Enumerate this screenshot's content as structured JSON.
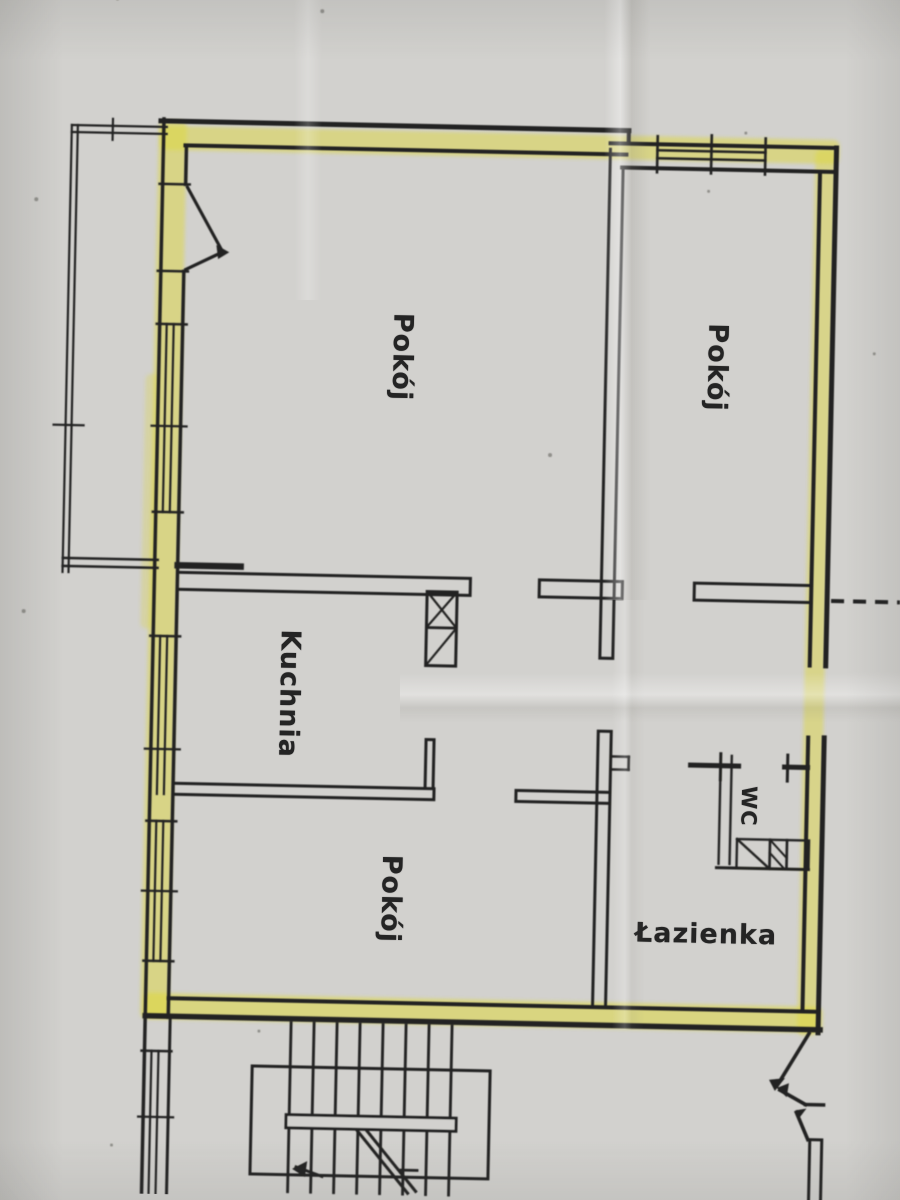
{
  "document": {
    "type": "scanned apartment floor plan"
  },
  "labels": {
    "room_top_left": "Pokój",
    "room_top_right": "Pokój",
    "kitchen": "Kuchnia",
    "room_bottom": "Pokój",
    "wc": "WC",
    "bathroom": "Łazienka"
  },
  "page": {
    "paper_color": "#d2d1ce",
    "ink_color": "#222220",
    "highlight_color": "#ded83e"
  },
  "plan": {
    "ink": "#222220",
    "paper": "#d2d1ce",
    "highlight": "#ded83e",
    "highlights": [
      [
        150,
        132,
        680,
        24,
        0.5
      ],
      [
        806,
        142,
        20,
        886,
        0.48
      ],
      [
        152,
        999,
        679,
        26,
        0.55
      ],
      [
        149,
        127,
        28,
        898,
        0.5
      ],
      [
        141,
        380,
        13,
        255,
        0.3
      ]
    ],
    "lines": [
      [
        151,
        127,
        619,
        127,
        5
      ],
      [
        176,
        151,
        617,
        151,
        4
      ],
      [
        619,
        127,
        619,
        140,
        4
      ],
      [
        601,
        140,
        827,
        140,
        4
      ],
      [
        613,
        164,
        827,
        164,
        4
      ],
      [
        154,
        125,
        154,
        1200,
        3.5
      ],
      [
        177,
        151,
        177,
        190,
        3.5
      ],
      [
        177,
        277,
        177,
        1023,
        3.5
      ],
      [
        179,
        1026,
        179,
        1200,
        3
      ],
      [
        827,
        140,
        827,
        658,
        5
      ],
      [
        827,
        730,
        827,
        1025,
        5
      ],
      [
        811,
        164,
        811,
        658,
        4
      ],
      [
        811,
        730,
        811,
        1004,
        4
      ],
      [
        154,
        1022,
        829,
        1022,
        5.5
      ],
      [
        177,
        1004,
        827,
        1004,
        4
      ],
      [
        177,
        578,
        470,
        578,
        3
      ],
      [
        177,
        595,
        470,
        595,
        3
      ],
      [
        470,
        578,
        470,
        595,
        3
      ],
      [
        539,
        578,
        622,
        578,
        3
      ],
      [
        539,
        595,
        622,
        595,
        3
      ],
      [
        539,
        578,
        539,
        595,
        3
      ],
      [
        622,
        578,
        622,
        595,
        3
      ],
      [
        694,
        578,
        811,
        578,
        3
      ],
      [
        694,
        595,
        811,
        595,
        3
      ],
      [
        694,
        578,
        694,
        595,
        3
      ],
      [
        177,
        571,
        240,
        571,
        6.5
      ],
      [
        62,
        566,
        157,
        566,
        2.4
      ],
      [
        62,
        574,
        157,
        574,
        2.4
      ],
      [
        601,
        146,
        601,
        655,
        3
      ],
      [
        614,
        164,
        614,
        655,
        3
      ],
      [
        601,
        655,
        614,
        655,
        3
      ],
      [
        601,
        728,
        601,
        1004,
        3
      ],
      [
        614,
        728,
        614,
        1004,
        3
      ],
      [
        601,
        728,
        614,
        728,
        3
      ],
      [
        614,
        753,
        632,
        753,
        2.6
      ],
      [
        614,
        766,
        632,
        766,
        2.6
      ],
      [
        632,
        753,
        632,
        766,
        2.6
      ],
      [
        177,
        789,
        438,
        789,
        3
      ],
      [
        177,
        800,
        438,
        800,
        3
      ],
      [
        438,
        789,
        438,
        800,
        3
      ],
      [
        520,
        789,
        614,
        789,
        3
      ],
      [
        520,
        800,
        614,
        800,
        3
      ],
      [
        520,
        789,
        520,
        800,
        3
      ],
      [
        429,
        740,
        429,
        789,
        3
      ],
      [
        437,
        740,
        437,
        789,
        3
      ],
      [
        429,
        740,
        437,
        740,
        3
      ],
      [
        427,
        628,
        457,
        628,
        2.8
      ],
      [
        427,
        592,
        457,
        628,
        2.2
      ],
      [
        457,
        592,
        427,
        628,
        2.2
      ],
      [
        427,
        666,
        457,
        628,
        2.2
      ],
      [
        694,
        760,
        742,
        760,
        5
      ],
      [
        788,
        760,
        811,
        760,
        5
      ],
      [
        724,
        748,
        724,
        774,
        3
      ],
      [
        791,
        748,
        791,
        774,
        3
      ],
      [
        724,
        750,
        724,
        858,
        2.4
      ],
      [
        735,
        750,
        735,
        858,
        2.4
      ],
      [
        722,
        862,
        814,
        862,
        3
      ],
      [
        742,
        833,
        775,
        862,
        2.4
      ],
      [
        775,
        833,
        792,
        851,
        2
      ],
      [
        775,
        846,
        790,
        862,
        2
      ],
      [
        648,
        146,
        756,
        146,
        2.4
      ],
      [
        648,
        154,
        756,
        154,
        2.4
      ],
      [
        648,
        132,
        648,
        168,
        2.6
      ],
      [
        702,
        130,
        702,
        168,
        2.6
      ],
      [
        756,
        132,
        756,
        168,
        2.6
      ],
      [
        161,
        330,
        161,
        518,
        2.2
      ],
      [
        168,
        330,
        168,
        518,
        2.2
      ],
      [
        151,
        330,
        181,
        330,
        2.4
      ],
      [
        151,
        518,
        181,
        518,
        2.4
      ],
      [
        148,
        432,
        183,
        432,
        2.2
      ],
      [
        161,
        642,
        161,
        800,
        2.2
      ],
      [
        168,
        642,
        168,
        800,
        2.2
      ],
      [
        151,
        642,
        181,
        642,
        2.4
      ],
      [
        148,
        755,
        183,
        755,
        2.2
      ],
      [
        161,
        827,
        161,
        967,
        2.2
      ],
      [
        168,
        827,
        168,
        967,
        2.2
      ],
      [
        151,
        827,
        181,
        827,
        2.4
      ],
      [
        151,
        967,
        181,
        967,
        2.4
      ],
      [
        148,
        897,
        183,
        897,
        2.2
      ],
      [
        161,
        1057,
        161,
        1200,
        2.2
      ],
      [
        168,
        1057,
        168,
        1200,
        2.2
      ],
      [
        151,
        1057,
        181,
        1057,
        2.4
      ],
      [
        149,
        1123,
        184,
        1123,
        2.2
      ],
      [
        151,
        190,
        181,
        190,
        2.6
      ],
      [
        151,
        277,
        181,
        277,
        2.6
      ],
      [
        179,
        193,
        215,
        256,
        3.2
      ],
      [
        179,
        275,
        213,
        258,
        3.2
      ],
      [
        62,
        133,
        62,
        580,
        2.2
      ],
      [
        68,
        133,
        68,
        580,
        2.2
      ],
      [
        62,
        133,
        157,
        133,
        2.2
      ],
      [
        62,
        140,
        157,
        140,
        2.2
      ],
      [
        50,
        433,
        80,
        433,
        2.2
      ],
      [
        103,
        126,
        103,
        147,
        2.2
      ],
      [
        300,
        1026,
        300,
        1195,
        2.8
      ],
      [
        323,
        1026,
        323,
        1195,
        2.8
      ],
      [
        346,
        1026,
        346,
        1195,
        2.8
      ],
      [
        369,
        1026,
        369,
        1195,
        2.8
      ],
      [
        392,
        1026,
        392,
        1195,
        2.8
      ],
      [
        415,
        1026,
        415,
        1195,
        2.8
      ],
      [
        438,
        1026,
        438,
        1195,
        2.8
      ],
      [
        461,
        1026,
        461,
        1195,
        2.8
      ],
      [
        368,
        1132,
        420,
        1194,
        3
      ],
      [
        376,
        1130,
        428,
        1192,
        3
      ],
      [
        308,
        1170,
        334,
        1179,
        3
      ],
      [
        413,
        1171,
        429,
        1171,
        2.8
      ],
      [
        818,
        1026,
        787,
        1079,
        3.6
      ],
      [
        790,
        1083,
        816,
        1097,
        3.6
      ],
      [
        816,
        1097,
        834,
        1097,
        3.6
      ],
      [
        807,
        1105,
        819,
        1132,
        3.6
      ],
      [
        821,
        1132,
        821,
        1192,
        3
      ],
      [
        833,
        1132,
        833,
        1192,
        3
      ],
      [
        821,
        1132,
        833,
        1132,
        3
      ]
    ],
    "rects": [
      [
        262,
        1070,
        238,
        108,
        3,
        "none"
      ],
      [
        427,
        592,
        30,
        74,
        3,
        "none"
      ],
      [
        742,
        833,
        33,
        29,
        2.4,
        "none"
      ],
      [
        775,
        833,
        17,
        29,
        2.4,
        "none"
      ],
      [
        792,
        833,
        22,
        29,
        2.4,
        "none"
      ],
      [
        297,
        1118,
        170,
        13,
        3,
        "paper"
      ]
    ],
    "dashes": [
      [
        831,
        593,
        900,
        593,
        4,
        "13,9"
      ]
    ],
    "arrows": [
      "222,257 209,250 211,264",
      "785,1084 795,1071 779,1073",
      "787,1081 799,1076 797,1090",
      "806,1103 817,1101 809,1112",
      "304,1172 319,1164 317,1180"
    ],
    "specks": [
      [
        310,
        14,
        2
      ],
      [
        105,
        6,
        1.5
      ],
      [
        28,
        208,
        2
      ],
      [
        24,
        620,
        2
      ],
      [
        547,
        453,
        2
      ],
      [
        736,
        127,
        1.5
      ],
      [
        869,
        345,
        1.5
      ],
      [
        123,
        1152,
        1.5
      ],
      [
        700,
        186,
        1.5
      ],
      [
        268,
        1035,
        1.5
      ]
    ]
  }
}
